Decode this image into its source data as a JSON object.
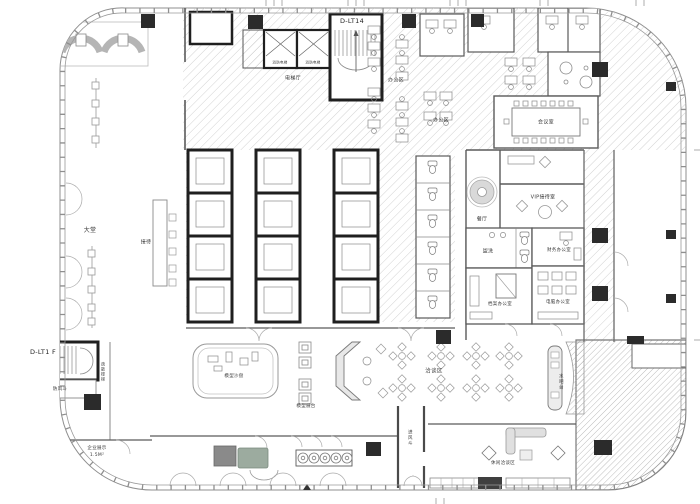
{
  "drawing": {
    "type": "architectural-floor-plan",
    "description": "Sales-center / lobby level plan with elevator core, offices, negotiation area and terrace"
  },
  "colors": {
    "wall_dark": "#1f1f1f",
    "wall_mid": "#5a5a5a",
    "hatch_light": "#c6c6c6",
    "hatch_dense": "#adadad",
    "column": "#2b2b2b",
    "accent_green": "#9cab9f",
    "text": "#3a3a3a"
  },
  "labels": [
    {
      "id": "stair-top",
      "text": "D-LT14",
      "x": 352,
      "y": 21,
      "fs": 6.5,
      "bg": true
    },
    {
      "id": "stair-bottom",
      "text": "D-LT1 F",
      "x": 43,
      "y": 352,
      "fs": 6.5,
      "bg": true
    },
    {
      "id": "lobby",
      "text": "大堂",
      "x": 90,
      "y": 231,
      "fs": 6
    },
    {
      "id": "reception",
      "text": "接待",
      "x": 146,
      "y": 243,
      "fs": 5
    },
    {
      "id": "elevator-hall",
      "text": "电梯厅",
      "x": 293,
      "y": 79,
      "fs": 5
    },
    {
      "id": "office-area-1",
      "text": "办公区",
      "x": 396,
      "y": 81,
      "fs": 5
    },
    {
      "id": "office-area-2",
      "text": "办公区",
      "x": 441,
      "y": 121,
      "fs": 5
    },
    {
      "id": "meeting-room",
      "text": "会议室",
      "x": 546,
      "y": 123,
      "fs": 5
    },
    {
      "id": "vip-room",
      "text": "VIP接待室",
      "x": 543,
      "y": 198,
      "fs": 5
    },
    {
      "id": "dining",
      "text": "餐厅",
      "x": 482,
      "y": 220,
      "fs": 5
    },
    {
      "id": "washroom",
      "text": "盥洗",
      "x": 488,
      "y": 252,
      "fs": 5
    },
    {
      "id": "finance-office",
      "text": "财务办公室",
      "x": 559,
      "y": 251,
      "fs": 4.5
    },
    {
      "id": "archive-office",
      "text": "档案办公室",
      "x": 500,
      "y": 305,
      "fs": 4.5
    },
    {
      "id": "computer-office",
      "text": "电脑办公室",
      "x": 558,
      "y": 303,
      "fs": 4.5
    },
    {
      "id": "negotiation-area",
      "text": "洽谈区",
      "x": 434,
      "y": 372,
      "fs": 5.5
    },
    {
      "id": "model-table",
      "text": "模型沙盘",
      "x": 234,
      "y": 377,
      "fs": 4.5
    },
    {
      "id": "model-display",
      "text": "模型展台",
      "x": 306,
      "y": 407,
      "fs": 4.5
    },
    {
      "id": "water-bar",
      "text": "水吧台",
      "x": 560,
      "y": 382,
      "fs": 4.5,
      "vertical": true
    },
    {
      "id": "lounge",
      "text": "休闲洽谈区",
      "x": 503,
      "y": 464,
      "fs": 4.5
    },
    {
      "id": "exhibition-line1",
      "text": "企业展示",
      "x": 97,
      "y": 449,
      "fs": 4.5
    },
    {
      "id": "exhibition-line2",
      "text": "1.5M²",
      "x": 97,
      "y": 456,
      "fs": 4.5
    },
    {
      "id": "windbreak",
      "text": "防风斗",
      "x": 60,
      "y": 390,
      "fs": 4.5
    },
    {
      "id": "wind-lobby",
      "text": "进风斗",
      "x": 409,
      "y": 438,
      "fs": 4.5,
      "vertical": true
    },
    {
      "id": "escape-stair",
      "text": "疏散楼梯",
      "x": 103,
      "y": 372,
      "fs": 4,
      "vertical": true
    },
    {
      "id": "fire-lift-1",
      "text": "消防电梯",
      "x": 280,
      "y": 63,
      "fs": 3.5
    },
    {
      "id": "fire-lift-2",
      "text": "消防电梯",
      "x": 313,
      "y": 63,
      "fs": 3.5
    }
  ]
}
